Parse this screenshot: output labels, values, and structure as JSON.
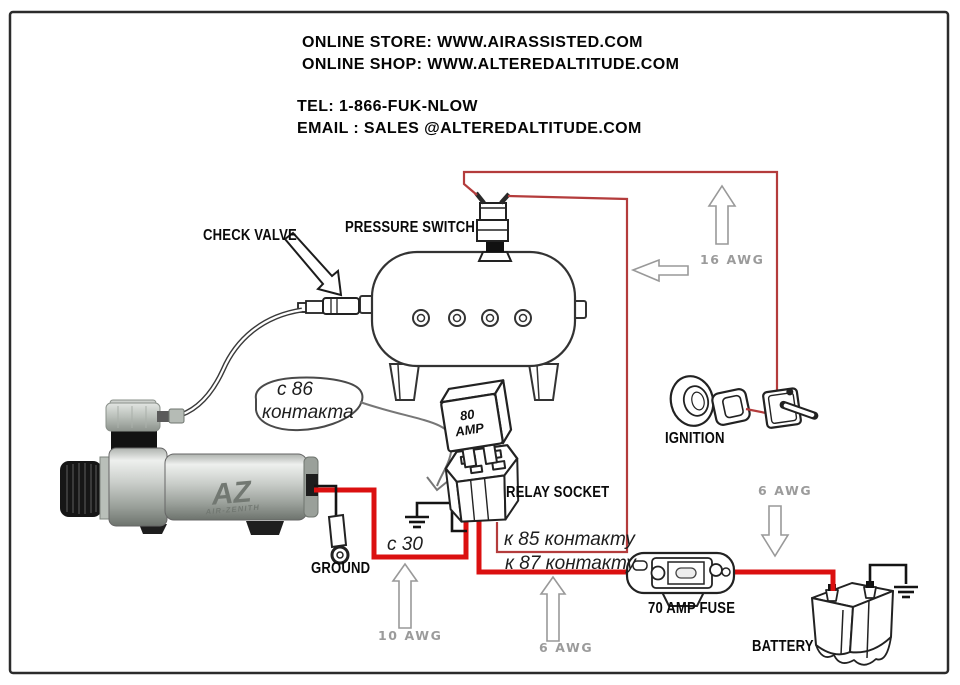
{
  "header": {
    "store_line": "ONLINE STORE: WWW.AIRASSISTED.COM",
    "shop_line": "ONLINE SHOP: WWW.ALTEREDALTITUDE.COM",
    "tel_line": "TEL: 1-866-FUK-NLOW",
    "email_line": "EMAIL : SALES @ALTEREDALTITUDE.COM"
  },
  "diagram": {
    "component_labels": {
      "check_valve": "CHECK VALVE",
      "pressure_switch": "PRESSURE SWITCH",
      "relay_socket": "RELAY SOCKET",
      "ground": "GROUND",
      "ignition": "IGNITION",
      "fuse": "70 AMP FUSE",
      "battery": "BATTERY"
    },
    "relay": {
      "line1": "80",
      "line2": "AMP"
    },
    "compressor": {
      "logo": "AZ",
      "logo_sub": "AIR-ZENITH"
    },
    "wire_gauge_labels": {
      "top": "16 AWG",
      "battery": "6 AWG",
      "compressor": "10 AWG",
      "relay_out": "6 AWG"
    },
    "contact_annotations": {
      "c86_line1": "с 86",
      "c86_line2": "контакта",
      "c30": "с 30",
      "k85": "к 85 контакту",
      "k87": "к 87 контакту"
    }
  },
  "colors": {
    "wire_power_red": "#db1010",
    "wire_signal_red": "#b43c3c",
    "wire_ground_black": "#141414",
    "gauge_label_gray": "#9b9b9b",
    "annotation_gray": "#555555"
  }
}
